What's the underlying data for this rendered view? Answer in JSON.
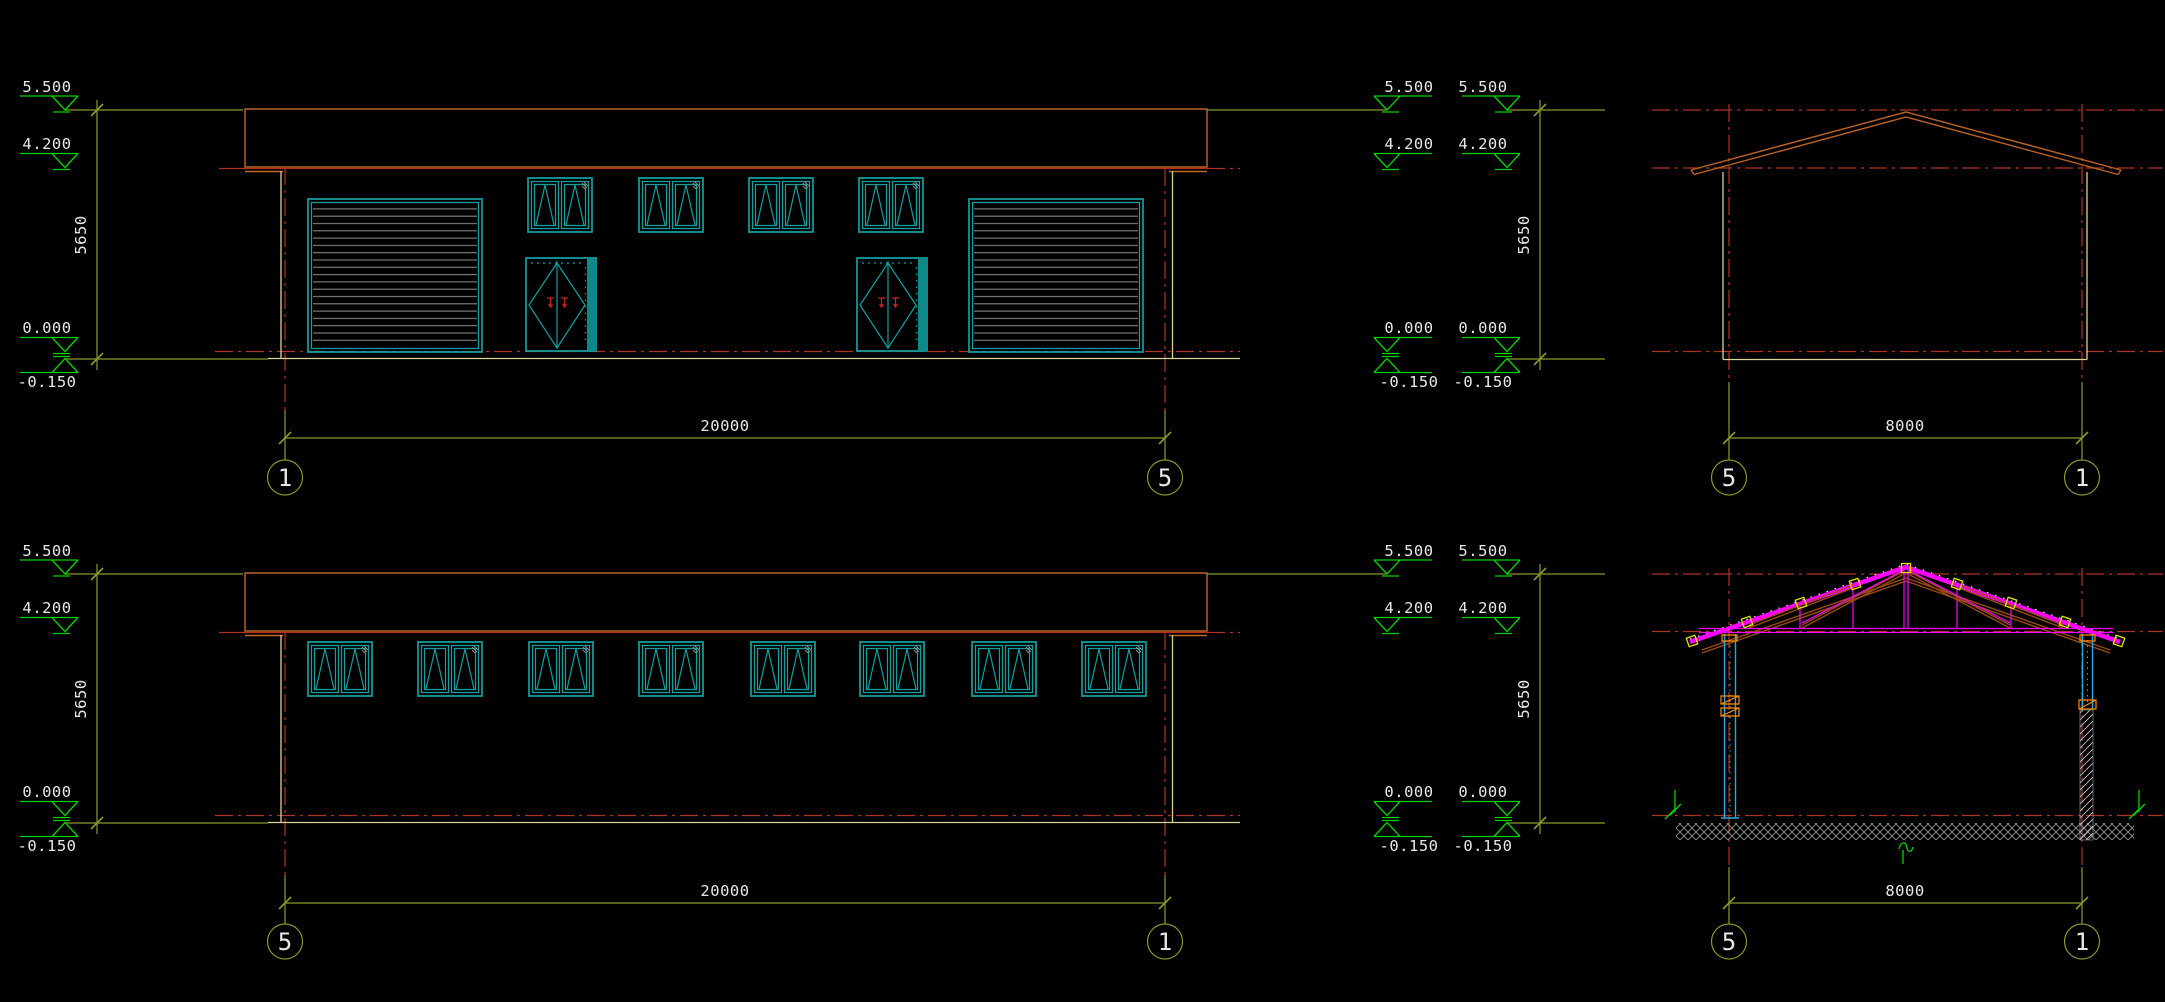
{
  "labels": {
    "level_top": "5.500",
    "level_eave": "4.200",
    "level_floor": "0.000",
    "level_grade": "-0.150",
    "dim_height": "5650",
    "dim_length": "20000",
    "dim_width": "8000",
    "grid_1": "1",
    "grid_5": "5"
  },
  "colors": {
    "background": "#000000",
    "level_green": "#00d400",
    "dim_olive": "#8a9a2a",
    "text_white": "#e8e8e8",
    "grid_red": "#b03322",
    "roof_orange": "#bc6426",
    "slat_gray": "#8c8c8c",
    "fixture_teal": "#12a0a0",
    "wall_yellow": "#d8d296",
    "truss_magenta": "#ff00ff",
    "truss_brown": "#9c4a10",
    "column_cyan": "#2aa8e0",
    "node_yellow": "#e6e600",
    "joint_orange": "#ff8c00"
  }
}
